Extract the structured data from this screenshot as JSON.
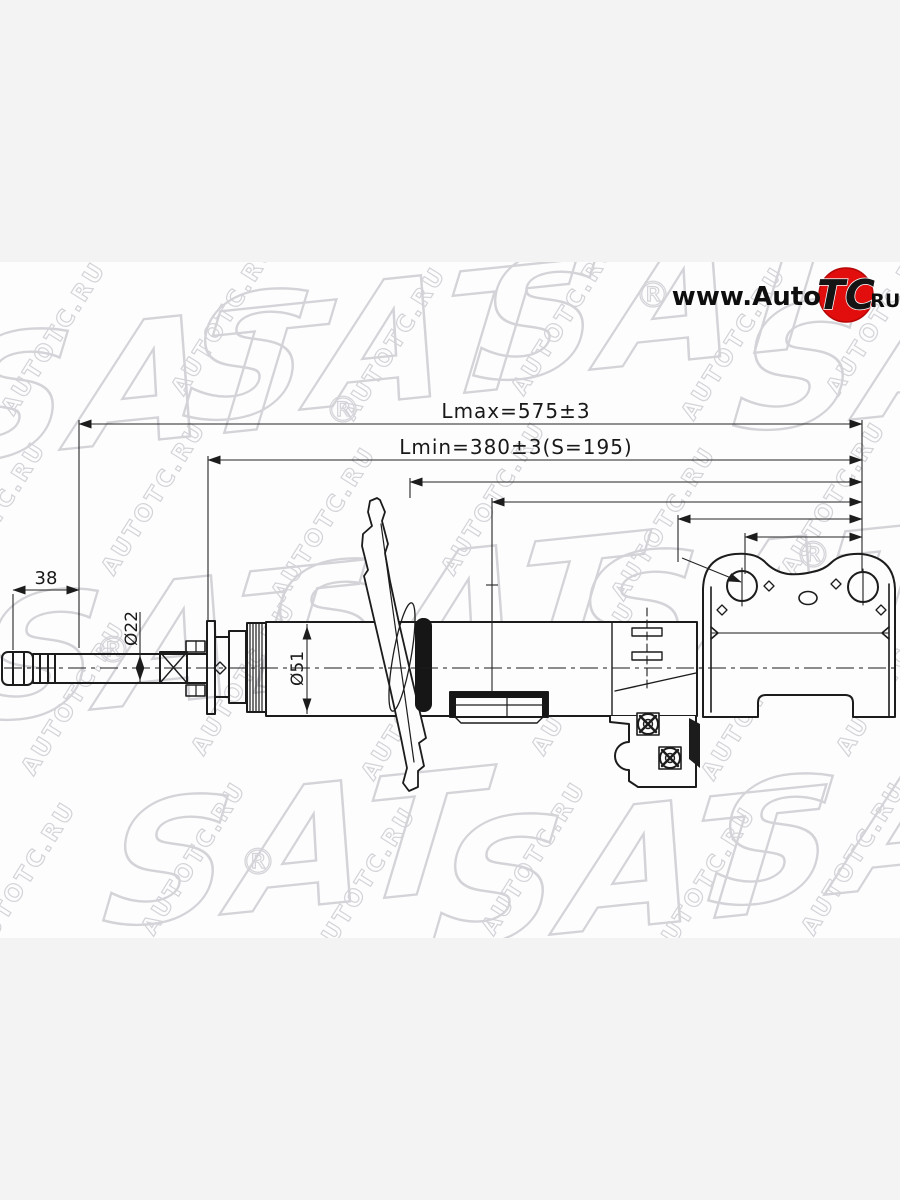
{
  "page": {
    "background": "#f3f3f4",
    "photo_background": "#fdfdfe"
  },
  "logo": {
    "prefix": "www.Auto",
    "emblem": "TC",
    "suffix": ".RU",
    "emblem_bg": "#e20d0d"
  },
  "watermark": {
    "text": "AUTOTC.RU",
    "brand": "SAT",
    "registered": "®",
    "color": "#cbccd1"
  },
  "drawing": {
    "line_color": "#1c1c1c",
    "labels": {
      "lmax": "Lmax=575±3",
      "lmin": "Lmin=380±3(S=195)",
      "thread_length": "38",
      "rod_diameter": "Ø22",
      "body_diameter": "Ø51"
    }
  }
}
